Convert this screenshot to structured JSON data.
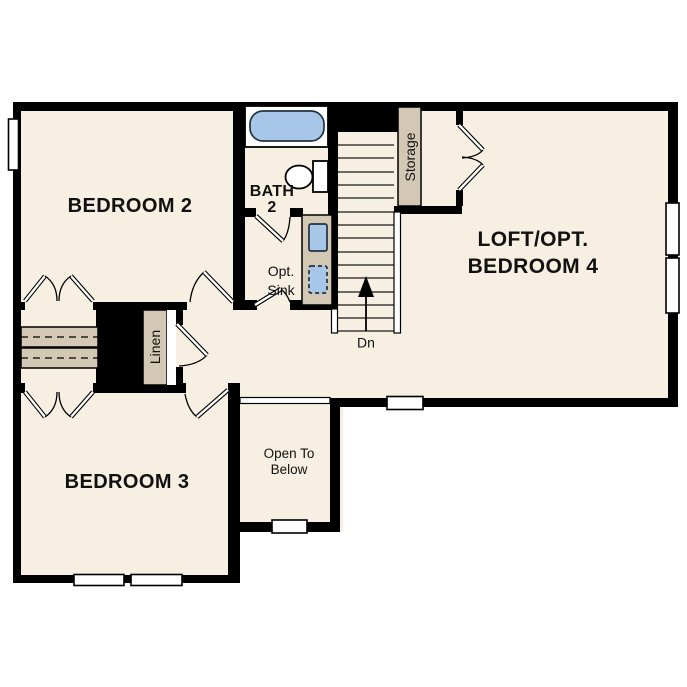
{
  "floorplan": {
    "labels": {
      "bedroom2": "BEDROOM 2",
      "bedroom3": "BEDROOM 3",
      "loft_line1": "LOFT/OPT.",
      "loft_line2": "BEDROOM 4",
      "bath_line1": "BATH",
      "bath_line2": "2",
      "opt_sink_line1": "Opt.",
      "opt_sink_line2": "Sink",
      "open_below_line1": "Open To",
      "open_below_line2": "Below",
      "storage": "Storage",
      "linen": "Linen",
      "stairs_direction": "Dn"
    },
    "colors": {
      "background": "#ffffff",
      "wall": "#000000",
      "floor": "#f6efe2",
      "fixture_tan": "#d3c8b3",
      "fixture_blue": "#a8c6e7",
      "text": "#111111"
    }
  }
}
